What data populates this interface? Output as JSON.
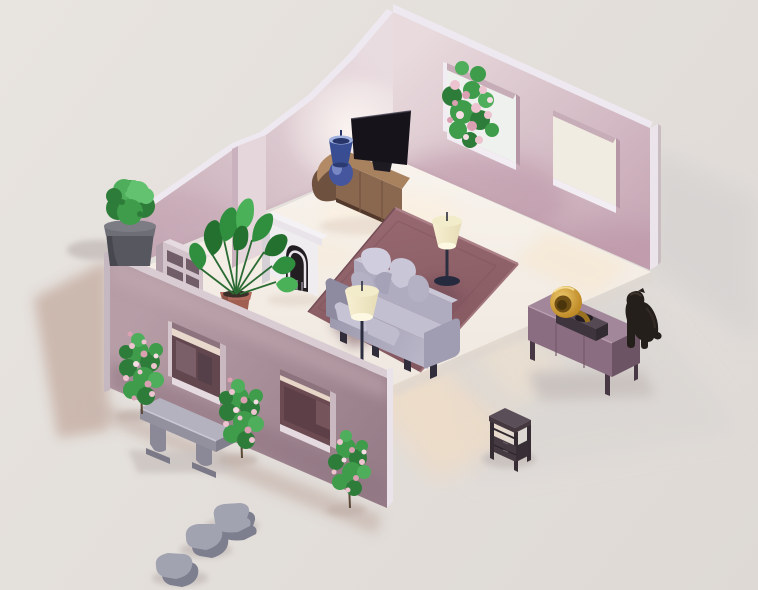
{
  "scene": {
    "description": "Isometric low-poly living room render: pink walls, sofa on mauve rug, TV console, fireplace, plants, garden wall with windows, bench, stepping stones, sideboard with gramophone, black dog and side table outside",
    "objects": [
      {
        "id": "floor",
        "label": "Room floor"
      },
      {
        "id": "back-left-wall",
        "label": "Back left wall"
      },
      {
        "id": "back-right-wall",
        "label": "Back right wall with two windows"
      },
      {
        "id": "garden-wall",
        "label": "Front garden wall with two windows"
      },
      {
        "id": "rug",
        "label": "Area rug"
      },
      {
        "id": "sofa",
        "label": "Sofa with pillows"
      },
      {
        "id": "floor-lamp-front",
        "label": "Floor lamp front"
      },
      {
        "id": "floor-lamp-rear",
        "label": "Floor lamp rear"
      },
      {
        "id": "tv",
        "label": "Flatscreen TV"
      },
      {
        "id": "tv-console",
        "label": "Rounded wooden TV console"
      },
      {
        "id": "table-lamp",
        "label": "Blue table lamp"
      },
      {
        "id": "fireplace",
        "label": "White fireplace"
      },
      {
        "id": "bookshelf",
        "label": "Bookshelf"
      },
      {
        "id": "houseplant",
        "label": "Potted houseplant"
      },
      {
        "id": "topiary",
        "label": "Potted topiary bush"
      },
      {
        "id": "window-rose-bush",
        "label": "Rose bush behind window"
      },
      {
        "id": "rose-bush-1",
        "label": "Climbing rose bush"
      },
      {
        "id": "rose-bush-2",
        "label": "Climbing rose bush"
      },
      {
        "id": "rose-bush-3",
        "label": "Climbing rose bush"
      },
      {
        "id": "bench",
        "label": "Stone garden bench"
      },
      {
        "id": "stepping-stones",
        "label": "Stepping stones"
      },
      {
        "id": "sideboard",
        "label": "Mauve sideboard"
      },
      {
        "id": "gramophone",
        "label": "Gramophone with brass horn"
      },
      {
        "id": "dog",
        "label": "Black dog sitting"
      },
      {
        "id": "side-table",
        "label": "Dark side table"
      }
    ],
    "palette": {
      "ground": "#e8e4e0",
      "groundDark": "#ded9d5",
      "shadowCool": "#d6d3d1",
      "shadowSoft": "#d9d6d3",
      "shadowWarm": "#c7b1a6",
      "shadowWarm2": "#c9b8b0",
      "shadowSmall": "#cac3c0",
      "shadowBush": "#c2b3ac",
      "lightWarm": "#eedcc7",
      "lightWarm2": "#f1e2cf",
      "lightWarm3": "#f6e9d6",
      "floorA": "#f8f3ec",
      "floorB": "#efe8e0",
      "floorGlow": "#faf0e2",
      "floorGlow2": "#f7ecdd",
      "floorAO": "#e2d3c6",
      "slabEdge": "#ded6cf",
      "gapDark": "#6e575f",
      "wallL1": "#e9dce0",
      "wallL2": "#c9adb8",
      "wallLWash": "#c2a3b1",
      "wallLAO": "#c0a3af",
      "glowWhite": "#fdf8f4",
      "trim": "#eee8f0",
      "capW": "#d9ccd4",
      "chimney": "#e5d6dc",
      "chimneySide": "#c9b2bd",
      "wallR1": "#e8dadd",
      "wallR2": "#c6a6b4",
      "wallRWash": "#b78da0",
      "wallRAO": "#bb97a6",
      "capE": "#ebe4ea",
      "capEdge": "#cabdc2",
      "winLight": "#eff1ee",
      "winWarm": "#f1ece2",
      "sill": "#f2edf2",
      "lintel": "#c7adb8",
      "jambDark": "#b697a5",
      "bushD": "#2e7c39",
      "bushM": "#3e9c4b",
      "bushL": "#63c26f",
      "bushHi": "#4fae5b",
      "roseA": "#ecc3cf",
      "roseB": "#daa0b2",
      "roseC": "#f6dde4",
      "trunk": "#5c4937",
      "shelfTop": "#e6dbe1",
      "shelfFront": "#d3c4cb",
      "shelfSide": "#b3a0aa",
      "shelfSlot": "#705d68",
      "fireFace": "#f0edf0",
      "fireSide": "#d6d0d7",
      "fireTop": "#f5f2f5",
      "fireDark": "#211d21",
      "fireInner": "#e8e4e9",
      "fireGrate": "#8a8590",
      "pot": "#a05f51",
      "potRim": "#b06a5b",
      "potDark": "#7e4a40",
      "soil": "#3a2e28",
      "stem": "#2b6b33",
      "leafD": "#23702f",
      "leafM": "#2f8f3e",
      "leafL": "#4ab158",
      "consoleTop": "#a8825f",
      "consoleTopCap": "#b28a66",
      "consoleFront": "#8a6850",
      "consoleCap": "#6f5140",
      "consoleDark": "#53392c",
      "consoleSeam": "#74553f",
      "tv": "#16131a",
      "tvHi": "#3a3747",
      "tvStand": "#1d1a22",
      "blueTop": "#a2b3e0",
      "blueShade": "#394e92",
      "blueInner": "#27356a",
      "blueBottom": "#2b3a70",
      "blueBulb": "#45569e",
      "blueHi": "#8b9cd4",
      "rugA": "#97686f",
      "rugB": "#83575f",
      "rugEdge": "#ab7f86",
      "rugEdge2": "#a1747c",
      "rugEdgeDark": "#744d56",
      "rugInner": "#7e545d",
      "sofaShadow": "#6f4a54",
      "sofaFront1": "#9b97ac",
      "sofaFront2": "#b9b6c8",
      "sofaTop": "#c2bfd1",
      "sofaBack": "#b0acc0",
      "sofaBackTop": "#c9c6d6",
      "sofaArmL": "#8e8aa0",
      "sofaArmR": "#a09cb1",
      "pillowA": "#d0cdde",
      "pillowB": "#c9c6d8",
      "pillowC": "#b5b1c4",
      "pillowD": "#a5a1b6",
      "cushion1": "#c6c3d4",
      "cushion2": "#bfbcce",
      "sofaLeg": "#322d3a",
      "shadeA": "#f7f0d2",
      "shadeB": "#e6dcb6",
      "shadeTop": "#f3ecca",
      "shadeGlow": "#fdf8e2",
      "pole": "#2b2e3f",
      "lampBase": "#252a3e",
      "garden1": "#b79da6",
      "garden2": "#977d88",
      "gardenWashD": "#8d7380",
      "gardenWashL": "#c3abb2",
      "gardenTrim": "#d9ccd3",
      "gardenCapW": "#c6b8c0",
      "gardenCapS": "#eae3ea",
      "winAback": "#63474f",
      "winAslice": "#e9d9cd",
      "winAshape1": "#7b5f68",
      "winAshape2": "#55404a",
      "winAsill": "#e5dae0",
      "winAjamb": "#c9b8c0",
      "winAlintel": "#8d737d",
      "winAjambL": "#d4c6cc",
      "winBback": "#6b4a52",
      "winBslice": "#e7d5c8",
      "winBdark": "#5d3f47",
      "winBlight": "#7d5a62",
      "benchTop": "#b4b2bf",
      "benchFront": "#94919f",
      "benchEnd": "#817e8d",
      "benchLeg": "#8b8997",
      "benchFoot": "#7b7987",
      "benchHi": "#c9c8d2",
      "potG": "#575760",
      "potGrim": "#6e6e77",
      "potGtop": "#7c7c85",
      "potGdark": "#44444c",
      "stone": "#a2a3b1",
      "stoneDark": "#7d7e8e",
      "stoneHi": "#b9bac6",
      "sbTop": "#a2879b",
      "sbFront": "#8a6d80",
      "sbSide": "#6d5464",
      "sbLeg": "#473844",
      "sbSeam": "#775c6d",
      "sbHi": "#b89dae",
      "gramFront": "#3e343d",
      "gramTop": "#554a54",
      "gramSide": "#332b32",
      "gramPlate": "#241e23",
      "hornA": "#edc96d",
      "hornB": "#c08c28",
      "hornIn": "#6f4f14",
      "hornDeep": "#4a350c",
      "hornRim": "#f3dc96",
      "hornNeck": "#9a7120",
      "dog": "#251f1c",
      "dogHi": "#463a30",
      "dogHi2": "#3d332b",
      "stTop": "#5a4e58",
      "stEdge": "#46383f",
      "stLeg": "#352d33",
      "stDrawer": "#453a42",
      "stSide": "#382f36",
      "stSeam": "#2b242b",
      "stHandle": "#6b5d66",
      "stShelf": "#2e272e"
    }
  }
}
